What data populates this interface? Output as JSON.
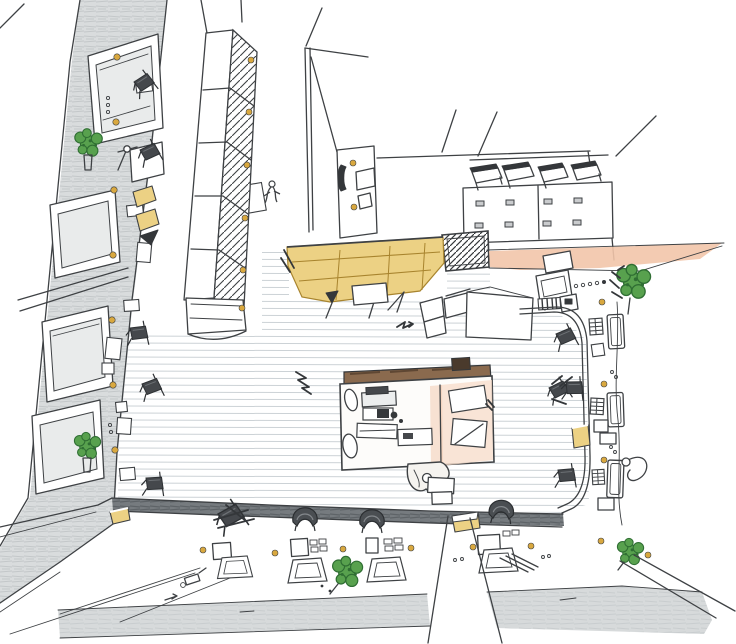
{
  "image": {
    "kind": "hand-drawn aerial perspective sketch",
    "medium": "ink line work with colored-pencil and watercolor washes",
    "subject": "bird's-eye view of a pedestrian plaza flanked by storefronts, market canopies, cafe terraces, a central vendor kiosk and a street along the bottom",
    "has_text": false
  },
  "colors": {
    "paper": "#ffffff",
    "ink": "#3e4144",
    "ink_dark": "#34373a",
    "pencil_light": "#d9dcdd",
    "pencil_streak": "#c3c7c9",
    "road_gray": "#d7dadb",
    "road_streak": "#c9cdcf",
    "curb_dark": "#767b7f",
    "curb_streak": "#5e6367",
    "awning_yellow": "#ecd184",
    "awning_frame": "#a8842e",
    "dot_orange": "#d9a83f",
    "wash_salmon": "#f2c5aa",
    "wash_salmon_light": "#f7dcc9",
    "foliage_green": "#58a14e",
    "foliage_dark": "#2f6e33",
    "kiosk_brown": "#8a6a4e",
    "paving_line": "#ccd2d6",
    "glass": "#e9ebeb"
  },
  "scene": {
    "elements": [
      {
        "name": "left-building-facade",
        "label": "shaded storefront facade seen from above, four large display windows"
      },
      {
        "name": "left-sidewalk-cafe",
        "label": "narrow sidewalk with small tables, dark chairs, lamp post, planters, yellow pavement dots"
      },
      {
        "name": "market-canopy-row",
        "label": "long segmented stall canopy with diagonally hatched roof and orange lamps"
      },
      {
        "name": "top-center-building",
        "label": "tall corner wall with door panel and signage"
      },
      {
        "name": "rooftop-pavilion",
        "label": "low pavilion with four tilted skylight panels and small windows"
      },
      {
        "name": "service-hatch",
        "label": "cross-hatched service block at plaza edge"
      },
      {
        "name": "yellow-awning",
        "label": "large yellow canvas awning over plaza entry"
      },
      {
        "name": "salmon-pavement",
        "label": "salmon-washed pavement strip tapering to the right"
      },
      {
        "name": "central-kiosk",
        "label": "vendor kiosk with counters, registers, drafting boards and attendant"
      },
      {
        "name": "plaza-paving",
        "label": "finely ruled plaza paving lines"
      },
      {
        "name": "right-terrace",
        "label": "curbed terrace with ladder chairs, tall tables and crates"
      },
      {
        "name": "cafe-row-bottom",
        "label": "cafe terrace row with hooded chairs, set tables and ramps"
      },
      {
        "name": "street-trees",
        "label": "small green street trees and shrubs"
      },
      {
        "name": "street-and-crossing",
        "label": "penciled roadway with pedestrian crossing and corner curbs"
      },
      {
        "name": "figures",
        "label": "small sketched pedestrians"
      }
    ]
  }
}
